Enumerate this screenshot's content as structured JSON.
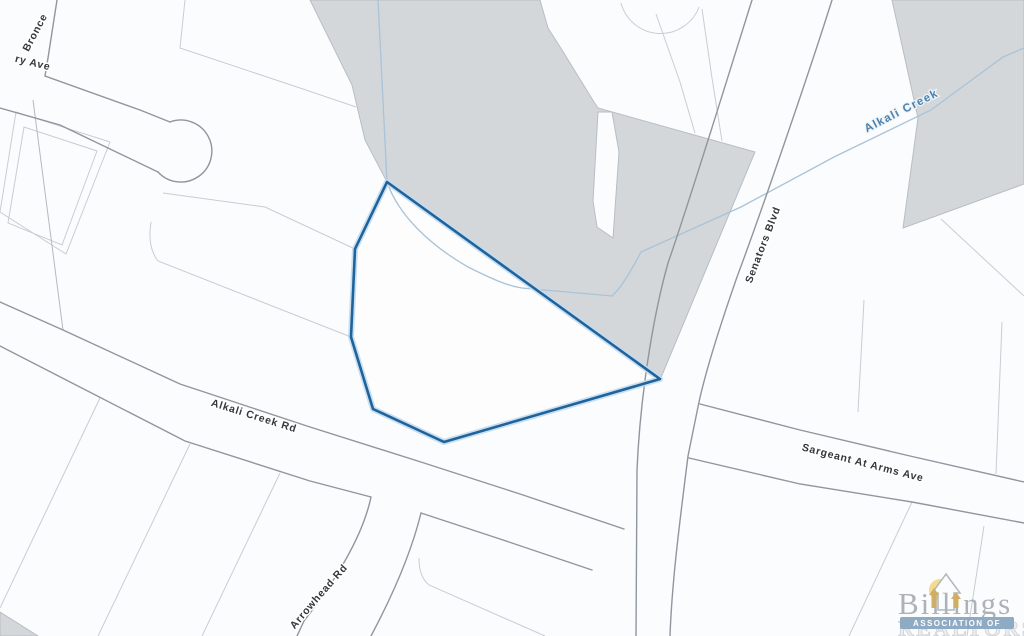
{
  "map": {
    "labels": {
      "bronce_st": "Bronce",
      "ry_ave": "ry Ave",
      "alkali_creek_rd": "Alkali Creek Rd",
      "senators_blvd": "Senators Blvd",
      "sargeant_at_arms_ave": "Sargeant At Arms Ave",
      "arrowhead_rd": "Arrowhead Rd",
      "alkali_creek": "Alkali Creek"
    },
    "colors": {
      "background": "#fbfcfd",
      "terrain_gray": "#d3d7da",
      "lot_line": "#c9cdd2",
      "road_line": "#8f969d",
      "creek_blue": "#a9c3d9",
      "creek_label_blue": "#4b80ad",
      "parcel_outline": "#1e639b",
      "parcel_halo": "#c3dcf0",
      "logo_gold": "#f0ca58",
      "logo_banner_blue": "#7d9cb9"
    },
    "logo": {
      "brand": "Billings",
      "banner": "ASSOCIATION OF",
      "realtors": "REALTORS®"
    }
  }
}
